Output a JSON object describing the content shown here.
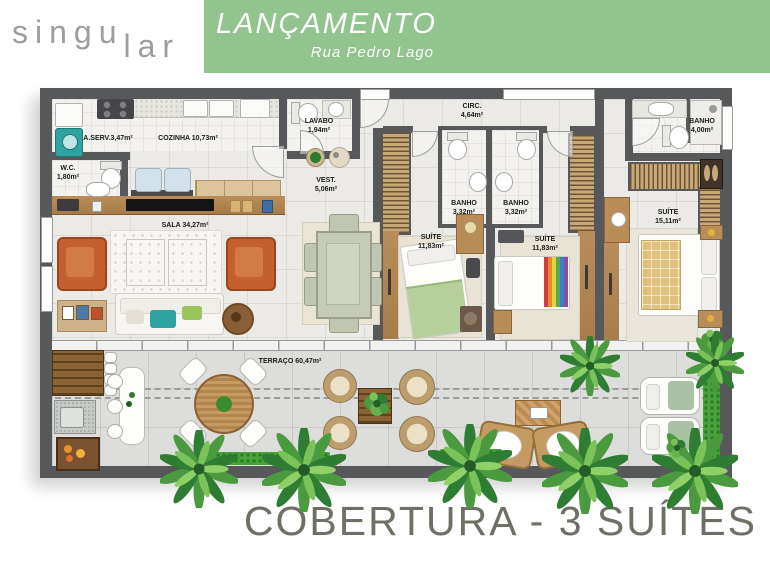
{
  "header": {
    "logo_part1": "singu",
    "logo_part2": "lar",
    "banner_title": "LANÇAMENTO",
    "banner_subtitle": "Rua Pedro Lago"
  },
  "rooms": {
    "aserv": {
      "label": "A.SERV.3,47m²"
    },
    "cozinha": {
      "label": "COZINHA 10,73m²"
    },
    "wc": {
      "name": "W.C.",
      "area": "1,80m²"
    },
    "lavabo": {
      "name": "LAVABO",
      "area": "1,94m²"
    },
    "vest": {
      "name": "VEST.",
      "area": "5,06m²"
    },
    "circ": {
      "name": "CIRC.",
      "area": "4,64m²"
    },
    "sala": {
      "label": "SALA 34,27m²"
    },
    "banho1": {
      "name": "BANHO",
      "area": "3,32m²"
    },
    "banho2": {
      "name": "BANHO",
      "area": "3,32m²"
    },
    "suite1": {
      "name": "SUÍTE",
      "area": "11,83m²"
    },
    "suite2": {
      "name": "SUÍTE",
      "area": "11,83m²"
    },
    "banho_master": {
      "name": "BANHO",
      "area": "4,00m²"
    },
    "suite_master": {
      "name": "SUÍTE",
      "area": "15,11m²"
    },
    "terraco": {
      "label": "TERRAÇO 60,47m²"
    }
  },
  "footer": {
    "title": "COBERTURA - 3 SUÍTES"
  },
  "colors": {
    "banner_green": "#92c48d",
    "wall_gray": "#57585a",
    "footer_text": "#6f7065",
    "wood": "#b98d59",
    "armchair_orange": "#c3602e"
  }
}
